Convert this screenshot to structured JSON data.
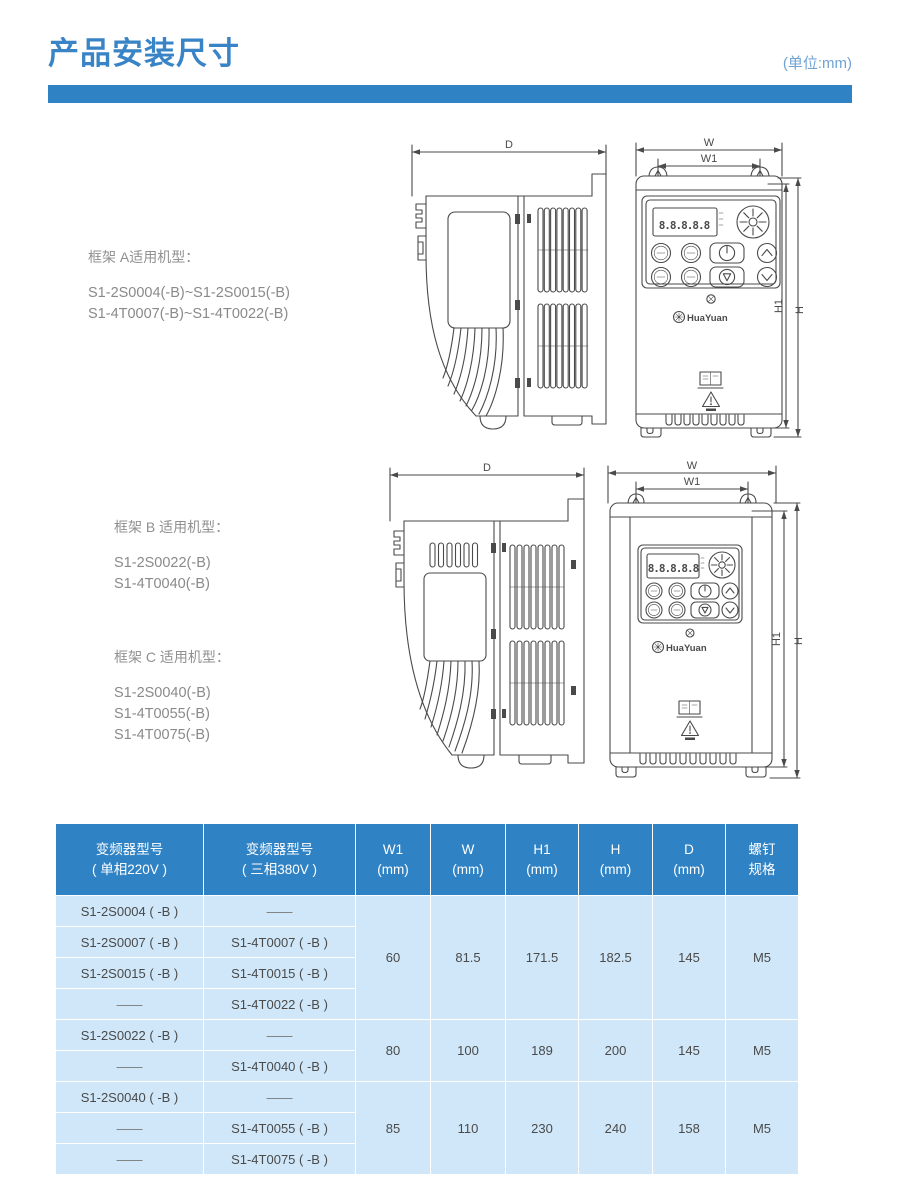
{
  "page": {
    "title": "产品安装尺寸",
    "unit_note": "(单位:mm)"
  },
  "sections": [
    {
      "label": "框架 A适用机型：",
      "models": [
        "S1-2S0004(-B)~S1-2S0015(-B)",
        "S1-4T0007(-B)~S1-4T0022(-B)"
      ]
    },
    {
      "label": "框架 B 适用机型：",
      "models": [
        "S1-2S0022(-B)",
        "S1-4T0040(-B)"
      ]
    },
    {
      "label": "框架 C 适用机型：",
      "models": [
        "S1-2S0040(-B)",
        "S1-4T0055(-B)",
        "S1-4T0075(-B)"
      ]
    }
  ],
  "diagrams": {
    "dims": {
      "d": "D",
      "w": "W",
      "w1": "W1",
      "h1": "H1",
      "h": "H"
    },
    "display_value": "8.8.8.8.8",
    "brand": "HuaYuan"
  },
  "table": {
    "headers": [
      [
        "变频器型号",
        "( 单相220V )"
      ],
      [
        "变频器型号",
        "( 三相380V )"
      ],
      [
        "W1",
        "(mm)"
      ],
      [
        "W",
        "(mm)"
      ],
      [
        "H1",
        "(mm)"
      ],
      [
        "H",
        "(mm)"
      ],
      [
        "D",
        "(mm)"
      ],
      [
        "螺钉",
        "规格"
      ]
    ],
    "groups": [
      {
        "rows": [
          [
            "S1-2S0004 ( -B )",
            "——"
          ],
          [
            "S1-2S0007 ( -B )",
            "S1-4T0007 ( -B )"
          ],
          [
            "S1-2S0015 ( -B )",
            "S1-4T0015 ( -B )"
          ],
          [
            "——",
            "S1-4T0022 ( -B )"
          ]
        ],
        "dims": [
          "60",
          "81.5",
          "171.5",
          "182.5",
          "145",
          "M5"
        ]
      },
      {
        "rows": [
          [
            "S1-2S0022 ( -B )",
            "——"
          ],
          [
            "——",
            "S1-4T0040 ( -B )"
          ]
        ],
        "dims": [
          "80",
          "100",
          "189",
          "200",
          "145",
          "M5"
        ]
      },
      {
        "rows": [
          [
            "S1-2S0040 ( -B )",
            "——"
          ],
          [
            "——",
            "S1-4T0055 ( -B )"
          ],
          [
            "——",
            "S1-4T0075 ( -B )"
          ]
        ],
        "dims": [
          "85",
          "110",
          "230",
          "240",
          "158",
          "M5"
        ]
      }
    ]
  }
}
